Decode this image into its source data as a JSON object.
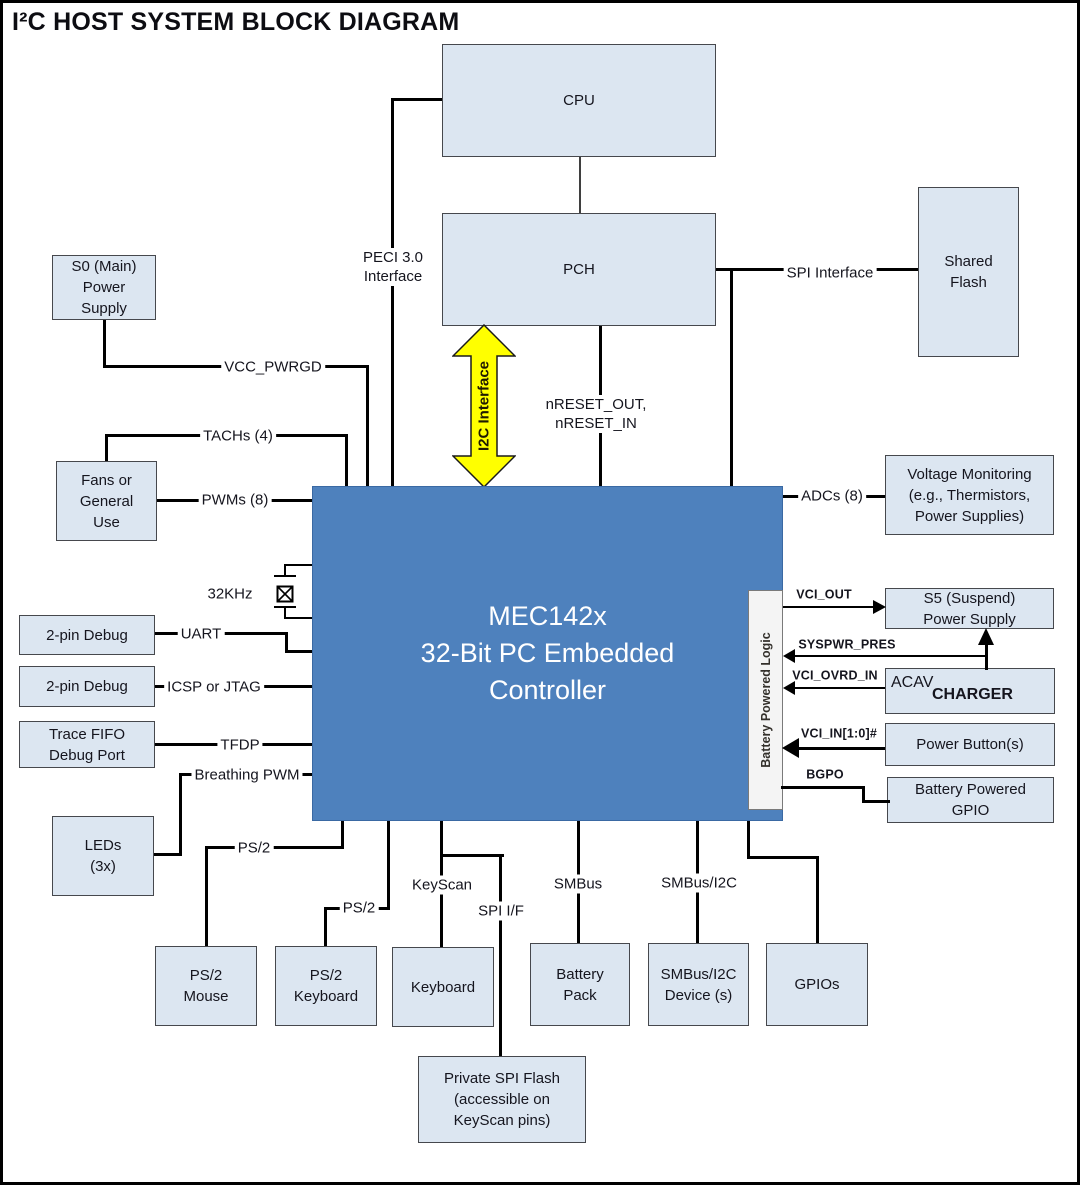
{
  "title": "I²C HOST SYSTEM BLOCK DIAGRAM",
  "blocks": {
    "cpu": "CPU",
    "pch": "PCH",
    "shared_flash": "Shared\nFlash",
    "s0_power": "S0 (Main)\nPower\nSupply",
    "fans": "Fans or\nGeneral\nUse",
    "debug_uart": "2-pin Debug",
    "debug_icsp": "2-pin Debug",
    "trace_fifo": "Trace FIFO\nDebug Port",
    "leds": "LEDs\n(3x)",
    "ps2_mouse": "PS/2\nMouse",
    "ps2_keyboard": "PS/2\nKeyboard",
    "keyboard": "Keyboard",
    "battery_pack": "Battery\nPack",
    "smbus_device": "SMBus/I2C\nDevice (s)",
    "gpios": "GPIOs",
    "private_flash": "Private SPI Flash\n(accessible on\nKeyScan pins)",
    "voltage_monitoring": "Voltage Monitoring\n(e.g., Thermistors,\nPower Supplies)",
    "s5_power": "S5 (Suspend)\nPower Supply",
    "charger_acav": "ACAV",
    "charger": "CHARGER",
    "power_buttons": "Power Button(s)",
    "battery_gpio": "Battery Powered\nGPIO",
    "mec": "MEC142x\n32-Bit PC Embedded\nController",
    "battery_logic": "Battery Powered Logic"
  },
  "wire_labels": {
    "peci": "PECI 3.0\nInterface",
    "vcc_pwrgd": "VCC_PWRGD",
    "tachs": "TACHs (4)",
    "pwms": "PWMs (8)",
    "khz32": "32KHz",
    "uart": "UART",
    "icsp": "ICSP or JTAG",
    "tfdp": "TFDP",
    "breathing_pwm": "Breathing PWM",
    "ps2_mouse": "PS/2",
    "ps2_keyboard": "PS/2",
    "keyscan": "KeyScan",
    "spi_if": "SPI I/F",
    "smbus": "SMBus",
    "smbus_i2c": "SMBus/I2C",
    "spi_interface": "SPI Interface",
    "nreset": "nRESET_OUT,\nnRESET_IN",
    "i2c_interface": "I2C Interface",
    "adcs": "ADCs (8)",
    "vci_out": "VCI_OUT",
    "syspwr_pres": "SYSPWR_PRES",
    "vci_ovrd_in": "VCI_OVRD_IN",
    "vci_in": "VCI_IN[1:0]#",
    "bgpo": "BGPO"
  },
  "colors": {
    "block_fill": "#dce6f1",
    "block_border": "#46484d",
    "controller_fill": "#4e81bd",
    "controller_text": "#ffffff",
    "wire": "#000000",
    "i2c_arrow_fill": "#ffff00",
    "battery_logic_strip_fill": "#f4f4f4"
  }
}
